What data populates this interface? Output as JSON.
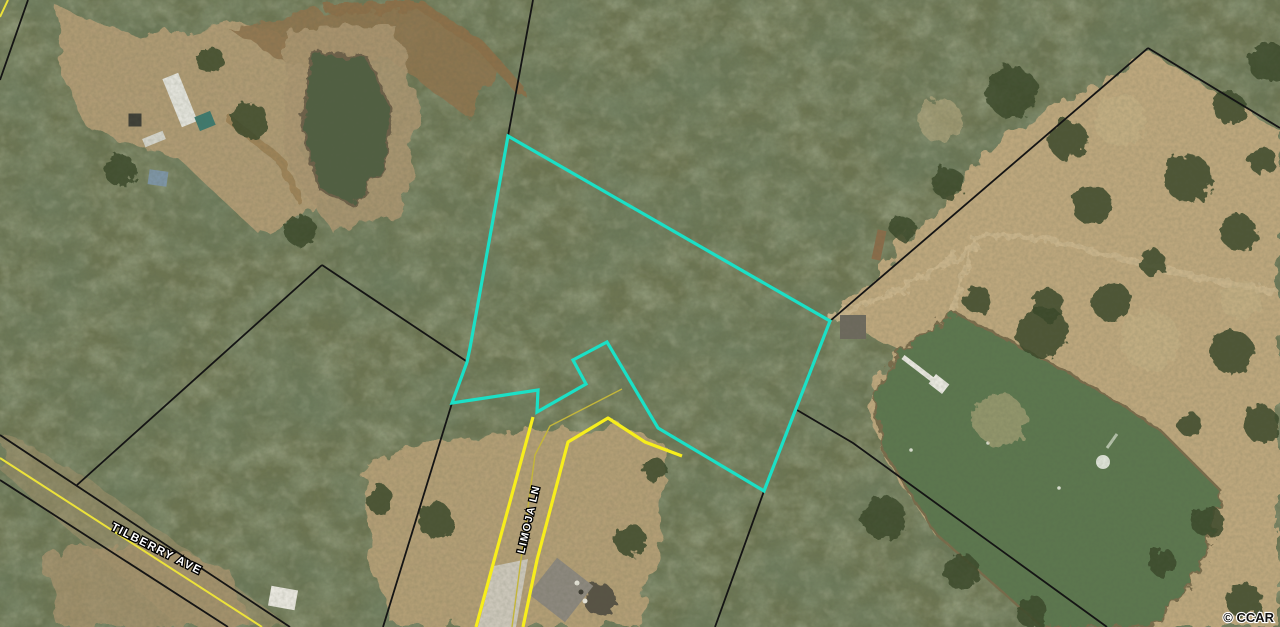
{
  "map": {
    "copyright": "© CCAR",
    "parcel_highlight": {
      "name": "highlighted-parcel-boundary",
      "color": "#1be0c6",
      "width": 3.2,
      "points": [
        [
          508,
          136
        ],
        [
          830,
          321
        ],
        [
          764,
          491
        ],
        [
          658,
          428
        ],
        [
          607,
          342
        ],
        [
          573,
          360
        ],
        [
          586,
          384
        ],
        [
          537,
          412
        ],
        [
          538,
          390
        ],
        [
          452,
          403
        ],
        [
          467,
          362
        ],
        [
          470,
          348
        ]
      ]
    },
    "labels": [
      {
        "name": "road-label-tilberry",
        "text": "TILBERRY AVE",
        "x": 155,
        "y": 552,
        "rotate": 27,
        "size": 11.5
      },
      {
        "name": "road-label-limoja",
        "text": "LIMOJA LN",
        "x": 532,
        "y": 520,
        "rotate": -77,
        "size": 10.5
      }
    ],
    "boundary_lines": [
      {
        "name": "parcel-line-top",
        "color": "#141414",
        "width": 1.8,
        "points": [
          [
            533,
            0
          ],
          [
            508,
            136
          ]
        ]
      },
      {
        "name": "parcel-line-ne-west",
        "color": "#141414",
        "width": 1.8,
        "points": [
          [
            1148,
            48
          ],
          [
            830,
            321
          ]
        ]
      },
      {
        "name": "parcel-line-ne-east",
        "color": "#141414",
        "width": 1.8,
        "points": [
          [
            1148,
            48
          ],
          [
            1280,
            128
          ]
        ]
      },
      {
        "name": "parcel-line-se",
        "color": "#141414",
        "width": 1.8,
        "points": [
          [
            797,
            410
          ],
          [
            853,
            443
          ],
          [
            1107,
            627
          ]
        ]
      },
      {
        "name": "parcel-line-south",
        "color": "#141414",
        "width": 1.8,
        "points": [
          [
            764,
            491
          ],
          [
            715,
            627
          ]
        ]
      },
      {
        "name": "parcel-line-west-upper",
        "color": "#141414",
        "width": 1.8,
        "points": [
          [
            322,
            265
          ],
          [
            466,
            361
          ]
        ]
      },
      {
        "name": "parcel-line-west-lower",
        "color": "#141414",
        "width": 1.8,
        "points": [
          [
            452,
            403
          ],
          [
            383,
            627
          ]
        ]
      },
      {
        "name": "parcel-line-sw-diagonal",
        "color": "#141414",
        "width": 1.8,
        "points": [
          [
            322,
            265
          ],
          [
            77,
            485
          ]
        ]
      },
      {
        "name": "tilberry-row-north",
        "color": "#141414",
        "width": 1.8,
        "points": [
          [
            0,
            435
          ],
          [
            290,
            627
          ]
        ]
      },
      {
        "name": "tilberry-row-south",
        "color": "#141414",
        "width": 1.8,
        "points": [
          [
            0,
            480
          ],
          [
            228,
            627
          ]
        ]
      },
      {
        "name": "parcel-line-corner-tl",
        "color": "#141414",
        "width": 1.8,
        "points": [
          [
            28,
            0
          ],
          [
            0,
            80
          ]
        ]
      }
    ],
    "road_lines": [
      {
        "name": "tilberry-centerline",
        "color": "#ece23a",
        "width": 2,
        "points": [
          [
            0,
            458
          ],
          [
            262,
            627
          ]
        ]
      },
      {
        "name": "yellow-corner-tl",
        "color": "#ece23a",
        "width": 2,
        "points": [
          [
            0,
            17
          ],
          [
            8,
            0
          ]
        ]
      },
      {
        "name": "limoja-row-west",
        "color": "#f7ee1c",
        "width": 3.2,
        "points": [
          [
            533,
            417
          ],
          [
            476,
            627
          ]
        ]
      },
      {
        "name": "limoja-row-east",
        "color": "#f7ee1c",
        "width": 3.2,
        "points": [
          [
            523,
            627
          ],
          [
            537,
            560
          ],
          [
            568,
            442
          ],
          [
            608,
            418
          ],
          [
            645,
            442
          ],
          [
            682,
            456
          ]
        ]
      },
      {
        "name": "limoja-centerline",
        "color": "#c4b63a",
        "width": 1.4,
        "points": [
          [
            512,
            627
          ],
          [
            535,
            455
          ],
          [
            550,
            426
          ],
          [
            622,
            389
          ]
        ]
      }
    ],
    "terrain": {
      "clearings": [
        {
          "name": "field-east",
          "color": "#bda77d",
          "opacity": 1,
          "points": [
            [
              836,
              318
            ],
            [
              1000,
              140
            ],
            [
              1148,
              50
            ],
            [
              1280,
              130
            ],
            [
              1280,
              627
            ],
            [
              1150,
              627
            ],
            [
              1100,
              560
            ],
            [
              1000,
              590
            ],
            [
              935,
              535
            ],
            [
              876,
              445
            ],
            [
              872,
              395
            ],
            [
              900,
              350
            ]
          ]
        },
        {
          "name": "clearing-top-left",
          "color": "#b29c75",
          "opacity": 0.95,
          "points": [
            [
              60,
              10
            ],
            [
              150,
              40
            ],
            [
              230,
              20
            ],
            [
              300,
              40
            ],
            [
              330,
              90
            ],
            [
              300,
              150
            ],
            [
              330,
              200
            ],
            [
              260,
              235
            ],
            [
              180,
              160
            ],
            [
              90,
              130
            ],
            [
              55,
              60
            ]
          ]
        },
        {
          "name": "dirt-swath-top",
          "color": "#8f7450",
          "opacity": 0.9,
          "points": [
            [
              230,
              30
            ],
            [
              320,
              10
            ],
            [
              420,
              0
            ],
            [
              500,
              60
            ],
            [
              470,
              120
            ],
            [
              390,
              60
            ],
            [
              300,
              70
            ]
          ]
        },
        {
          "name": "clearing-bottom-center",
          "color": "#b6a077",
          "opacity": 0.95,
          "points": [
            [
              360,
              470
            ],
            [
              430,
              440
            ],
            [
              530,
              430
            ],
            [
              620,
              425
            ],
            [
              665,
              445
            ],
            [
              660,
              540
            ],
            [
              640,
              627
            ],
            [
              395,
              627
            ],
            [
              370,
              560
            ]
          ]
        },
        {
          "name": "clearing-bottom-left",
          "color": "#a8936e",
          "opacity": 0.8,
          "points": [
            [
              40,
              555
            ],
            [
              140,
              540
            ],
            [
              230,
              570
            ],
            [
              250,
              627
            ],
            [
              60,
              627
            ]
          ]
        },
        {
          "name": "tilberry-corridor",
          "color": "#a7936d",
          "opacity": 0.5,
          "points": [
            [
              0,
              430
            ],
            [
              90,
              480
            ],
            [
              200,
              560
            ],
            [
              290,
              627
            ],
            [
              180,
              627
            ],
            [
              0,
              470
            ]
          ]
        },
        {
          "name": "shore-upper-pond",
          "color": "#ab9671",
          "opacity": 0.9,
          "points": [
            [
              285,
              30
            ],
            [
              395,
              25
            ],
            [
              420,
              110
            ],
            [
              400,
              215
            ],
            [
              330,
              230
            ],
            [
              285,
              160
            ]
          ]
        }
      ],
      "paths": [
        {
          "name": "driveway-east-parcel",
          "color": "#cbb68d",
          "width": 6,
          "points": [
            [
              832,
              318
            ],
            [
              870,
              302
            ],
            [
              905,
              287
            ],
            [
              950,
              262
            ],
            [
              987,
              235
            ],
            [
              1050,
              240
            ],
            [
              1120,
              258
            ],
            [
              1200,
              278
            ],
            [
              1276,
              292
            ]
          ]
        },
        {
          "name": "driveway-branch-pond",
          "color": "#cbb68d",
          "width": 4,
          "points": [
            [
              975,
              240
            ],
            [
              958,
              295
            ],
            [
              942,
              340
            ]
          ]
        },
        {
          "name": "dirt-road-top",
          "color": "#8d7048",
          "width": 10,
          "points": [
            [
              330,
              10
            ],
            [
              420,
              5
            ],
            [
              480,
              45
            ],
            [
              520,
              90
            ]
          ]
        },
        {
          "name": "trail-top-left",
          "color": "#9c8257",
          "width": 8,
          "points": [
            [
              230,
              120
            ],
            [
              280,
              160
            ],
            [
              300,
              200
            ]
          ]
        }
      ]
    },
    "water": {
      "bodies": [
        {
          "name": "pond-main",
          "fill": "#5b7750",
          "stroke": "#7a6c4c",
          "points": [
            [
              955,
              312
            ],
            [
              1030,
              352
            ],
            [
              1090,
              385
            ],
            [
              1160,
              430
            ],
            [
              1222,
              492
            ],
            [
              1205,
              558
            ],
            [
              1178,
              600
            ],
            [
              1148,
              627
            ],
            [
              1042,
              627
            ],
            [
              998,
              588
            ],
            [
              936,
              534
            ],
            [
              884,
              452
            ],
            [
              872,
              398
            ],
            [
              898,
              352
            ]
          ]
        },
        {
          "name": "pond-upper-left",
          "fill": "#515f43",
          "stroke": "#6e6148",
          "points": [
            [
              312,
              52
            ],
            [
              368,
              58
            ],
            [
              392,
              112
            ],
            [
              382,
              172
            ],
            [
              352,
              205
            ],
            [
              318,
              188
            ],
            [
              302,
              125
            ]
          ]
        }
      ],
      "dock": {
        "name": "dock",
        "walkway": [
          [
            903,
            357
          ],
          [
            933,
            380
          ]
        ],
        "platform": {
          "x": 939,
          "y": 384,
          "w": 17,
          "h": 12,
          "rot": 38
        },
        "color": "#e9e8e0"
      },
      "fountain": {
        "name": "fountain",
        "x": 1103,
        "y": 462,
        "r": 7,
        "wake": [
          [
            1107,
            448
          ],
          [
            1117,
            434
          ]
        ],
        "color": "#dfe3d8"
      },
      "dots": [
        [
          988,
          443
        ],
        [
          911,
          450
        ],
        [
          1059,
          488
        ]
      ]
    },
    "vegetation": [
      {
        "x": 1012,
        "y": 92,
        "r": 26
      },
      {
        "x": 1068,
        "y": 140,
        "r": 20
      },
      {
        "x": 948,
        "y": 183,
        "r": 16
      },
      {
        "x": 1092,
        "y": 205,
        "r": 20
      },
      {
        "x": 1188,
        "y": 178,
        "r": 24
      },
      {
        "x": 1238,
        "y": 232,
        "r": 18
      },
      {
        "x": 1152,
        "y": 262,
        "r": 13
      },
      {
        "x": 1048,
        "y": 305,
        "r": 16
      },
      {
        "x": 903,
        "y": 228,
        "r": 12
      },
      {
        "x": 978,
        "y": 300,
        "r": 14
      },
      {
        "x": 1042,
        "y": 332,
        "r": 26
      },
      {
        "x": 1112,
        "y": 302,
        "r": 20
      },
      {
        "x": 1232,
        "y": 352,
        "r": 22
      },
      {
        "x": 1262,
        "y": 425,
        "r": 18
      },
      {
        "x": 1190,
        "y": 425,
        "r": 12
      },
      {
        "x": 1208,
        "y": 522,
        "r": 16
      },
      {
        "x": 1162,
        "y": 562,
        "r": 14
      },
      {
        "x": 1244,
        "y": 600,
        "r": 18
      },
      {
        "x": 1032,
        "y": 612,
        "r": 16
      },
      {
        "x": 962,
        "y": 572,
        "r": 18
      },
      {
        "x": 884,
        "y": 518,
        "r": 22
      },
      {
        "x": 1268,
        "y": 62,
        "r": 20
      },
      {
        "x": 1230,
        "y": 108,
        "r": 16
      },
      {
        "x": 1262,
        "y": 160,
        "r": 14
      },
      {
        "x": 435,
        "y": 520,
        "r": 18
      },
      {
        "x": 630,
        "y": 540,
        "r": 16
      },
      {
        "x": 655,
        "y": 470,
        "r": 12
      },
      {
        "x": 380,
        "y": 500,
        "r": 14
      },
      {
        "x": 600,
        "y": 600,
        "r": 16,
        "color": "#4a463c"
      },
      {
        "x": 250,
        "y": 120,
        "r": 18
      },
      {
        "x": 210,
        "y": 60,
        "r": 14
      },
      {
        "x": 120,
        "y": 170,
        "r": 16
      },
      {
        "x": 300,
        "y": 230,
        "r": 16
      },
      {
        "x": 1150,
        "y": 340,
        "r": 30,
        "color": "#c6b388",
        "o": 0.5
      },
      {
        "x": 1000,
        "y": 420,
        "r": 26,
        "color": "#c6b388",
        "o": 0.5
      },
      {
        "x": 1240,
        "y": 300,
        "r": 20,
        "color": "#c6b388",
        "o": 0.5
      },
      {
        "x": 940,
        "y": 120,
        "r": 22,
        "color": "#c6b388",
        "o": 0.5
      },
      {
        "x": 1120,
        "y": 120,
        "r": 26,
        "color": "#c6b388",
        "o": 0.5
      }
    ],
    "structures": [
      {
        "name": "mobile-home-white",
        "x": 180,
        "y": 100,
        "w": 17,
        "h": 52,
        "rot": -22,
        "fill": "#e2e2da"
      },
      {
        "name": "teal-roof-building",
        "x": 205,
        "y": 121,
        "w": 17,
        "h": 15,
        "rot": -22,
        "fill": "#3f7a6e"
      },
      {
        "name": "dark-shed-tl",
        "x": 135,
        "y": 120,
        "w": 13,
        "h": 13,
        "rot": 0,
        "fill": "#3e3e36"
      },
      {
        "name": "white-trailer",
        "x": 154,
        "y": 139,
        "w": 22,
        "h": 9,
        "rot": -22,
        "fill": "#d5d5cc"
      },
      {
        "name": "blue-tarp-roof",
        "x": 158,
        "y": 178,
        "w": 19,
        "h": 15,
        "rot": 8,
        "fill": "#7e95a5"
      },
      {
        "name": "entry-shed-east",
        "x": 853,
        "y": 327,
        "w": 26,
        "h": 24,
        "rot": 0,
        "fill": "#6e6a5e"
      },
      {
        "name": "wood-structure-east",
        "x": 879,
        "y": 245,
        "w": 9,
        "h": 30,
        "rot": 12,
        "fill": "#8a6d4a"
      },
      {
        "name": "house-roof-bottom",
        "x": 561,
        "y": 590,
        "w": 46,
        "h": 46,
        "rot": 38,
        "fill": "#8d887e"
      },
      {
        "name": "white-roof-bottom-left",
        "x": 283,
        "y": 598,
        "w": 27,
        "h": 20,
        "rot": 10,
        "fill": "#e9e7df"
      },
      {
        "name": "driveway-slab",
        "polygon": [
          [
            494,
            566
          ],
          [
            528,
            559
          ],
          [
            516,
            627
          ],
          [
            478,
            627
          ]
        ],
        "fill": "#ccc7ba"
      }
    ],
    "ground_specks": [
      {
        "x": 577,
        "y": 583,
        "r": 2.5,
        "color": "#e8e6da"
      },
      {
        "x": 585,
        "y": 601,
        "r": 2.5,
        "color": "#e8e6da"
      },
      {
        "x": 581,
        "y": 592,
        "r": 2.5,
        "color": "#3c3a32"
      }
    ]
  }
}
